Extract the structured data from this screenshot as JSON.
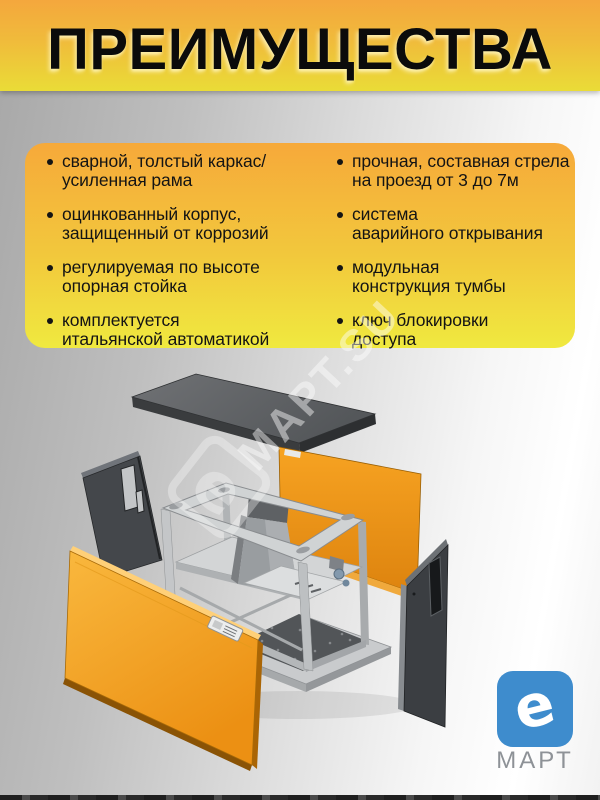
{
  "page": {
    "title": "ПРЕИМУЩЕСТВА"
  },
  "advantages": {
    "left": [
      {
        "lines": [
          "сварной, толстый каркас/",
          "усиленная рама"
        ]
      },
      {
        "lines": [
          "оцинкованный корпус,",
          "защищенный от коррозий"
        ]
      },
      {
        "lines": [
          "регулируемая по высоте",
          "опорная стойка"
        ]
      },
      {
        "lines": [
          "комплектуется",
          "итальянской автоматикой"
        ]
      }
    ],
    "right": [
      {
        "lines": [
          "прочная, составная стрела",
          "на проезд от 3 до 7м"
        ]
      },
      {
        "lines": [
          "система",
          "аварийного открывания"
        ]
      },
      {
        "lines": [
          "модульная",
          "конструкция тумбы"
        ]
      },
      {
        "lines": [
          "ключ блокировки",
          "доступа"
        ]
      }
    ]
  },
  "watermark": {
    "emblem_letter": "e",
    "text": "МАРТ.SU"
  },
  "logo": {
    "emblem_letter": "e",
    "brand": "МАРТ"
  },
  "colors": {
    "header_gradient_top": "#f4a73d",
    "header_gradient_bottom": "#eadc37",
    "panel_gradient_top": "#f6a93a",
    "panel_gradient_bottom": "#f0e93f",
    "background_left": "#a7a7a7",
    "background_right": "#ffffff",
    "orange_panel": "#f29b1c",
    "dark_panel": "#3c3f43",
    "frame_gray": "#cfd2d3",
    "logo_blue": "#3e8ccd",
    "brand_gray": "#8e9297",
    "text_black": "#141414"
  }
}
